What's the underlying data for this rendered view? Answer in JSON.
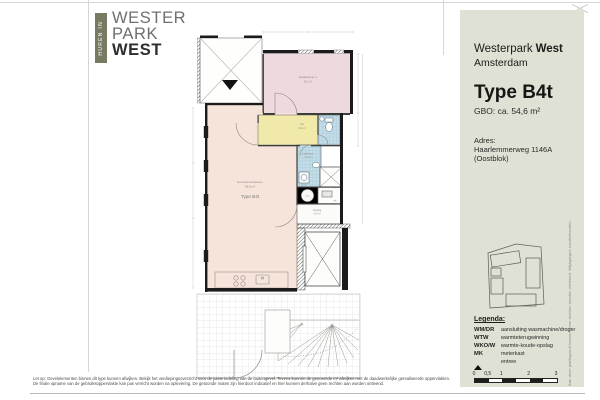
{
  "logo": {
    "tab": "HUREN IN",
    "line1": "WESTER",
    "line2": "PARK",
    "line3": "WEST"
  },
  "sidebar": {
    "project_regular": "Westerpark",
    "project_bold": "West",
    "city": "Amsterdam",
    "type_title": "Type B4t",
    "gbo": "GBO: ca. 54,6 m²",
    "address_label": "Adres:",
    "address_value": "Haarlemmerweg 1146A (Oostblok)",
    "legend": {
      "title": "Legenda:",
      "items": [
        {
          "code": "WM/DR",
          "label": "aansluiting wasmachine/droger"
        },
        {
          "code": "WTW",
          "label": "warmteterugwinning"
        },
        {
          "code": "WKO/W",
          "label": "warmte-koude-opslag"
        },
        {
          "code": "MK",
          "label": "meterkast"
        },
        {
          "code": "",
          "label": "entree"
        }
      ]
    },
    "scalebar_labels": [
      "0",
      "0,5",
      "1",
      "2",
      "3"
    ],
    "vertical_disclaimer": "Aan deze plattegrond kunnen geen rechten worden ontleend. Wijzigingen voorbehouden."
  },
  "plan": {
    "rooms": {
      "living": {
        "name": "woonkamer/keuken",
        "area": "28,0 m²",
        "type_label": "Type B4t"
      },
      "bedroom": {
        "name": "slaapkamer 1",
        "area": "9,2 m²"
      },
      "hall": {
        "name": "hal",
        "area": "3,6 m²"
      },
      "bathroom": {
        "name": "badkamer",
        "area": "3,9 m²"
      },
      "storage": {
        "name": "berging",
        "area": "2,9 m²"
      }
    },
    "tech_labels": {
      "wtw": "wtw",
      "mk": "mk",
      "wmdr": "wm/dr"
    }
  },
  "footer": {
    "line1": "Let op: Gevelelementen binnen dit type kunnen afwijken. Bekijk het verdiepingsoverzicht voor de juiste indeling van de buitengevel. Tevens kunnen de genoemde m² afwijken met de daadwerkelijke gerealiseerde oppervlakten.",
    "line2": "De finale opname van de gebruiksoppervlakte kan pas verricht worden na oplevering. De getoonde maten zijn hierdoor indicatief en hier kunnen derhalve geen rechten aan worden ontleend."
  },
  "colors": {
    "sidebar_bg": "#dee1d4",
    "logo_olive": "#787a62",
    "bedroom_pink": "#eedade",
    "living_peach": "#f6e3da",
    "hall_yellow": "#f1e9a9",
    "tile_blue": "#c3dde8",
    "wall_black": "#1b1b1b"
  }
}
